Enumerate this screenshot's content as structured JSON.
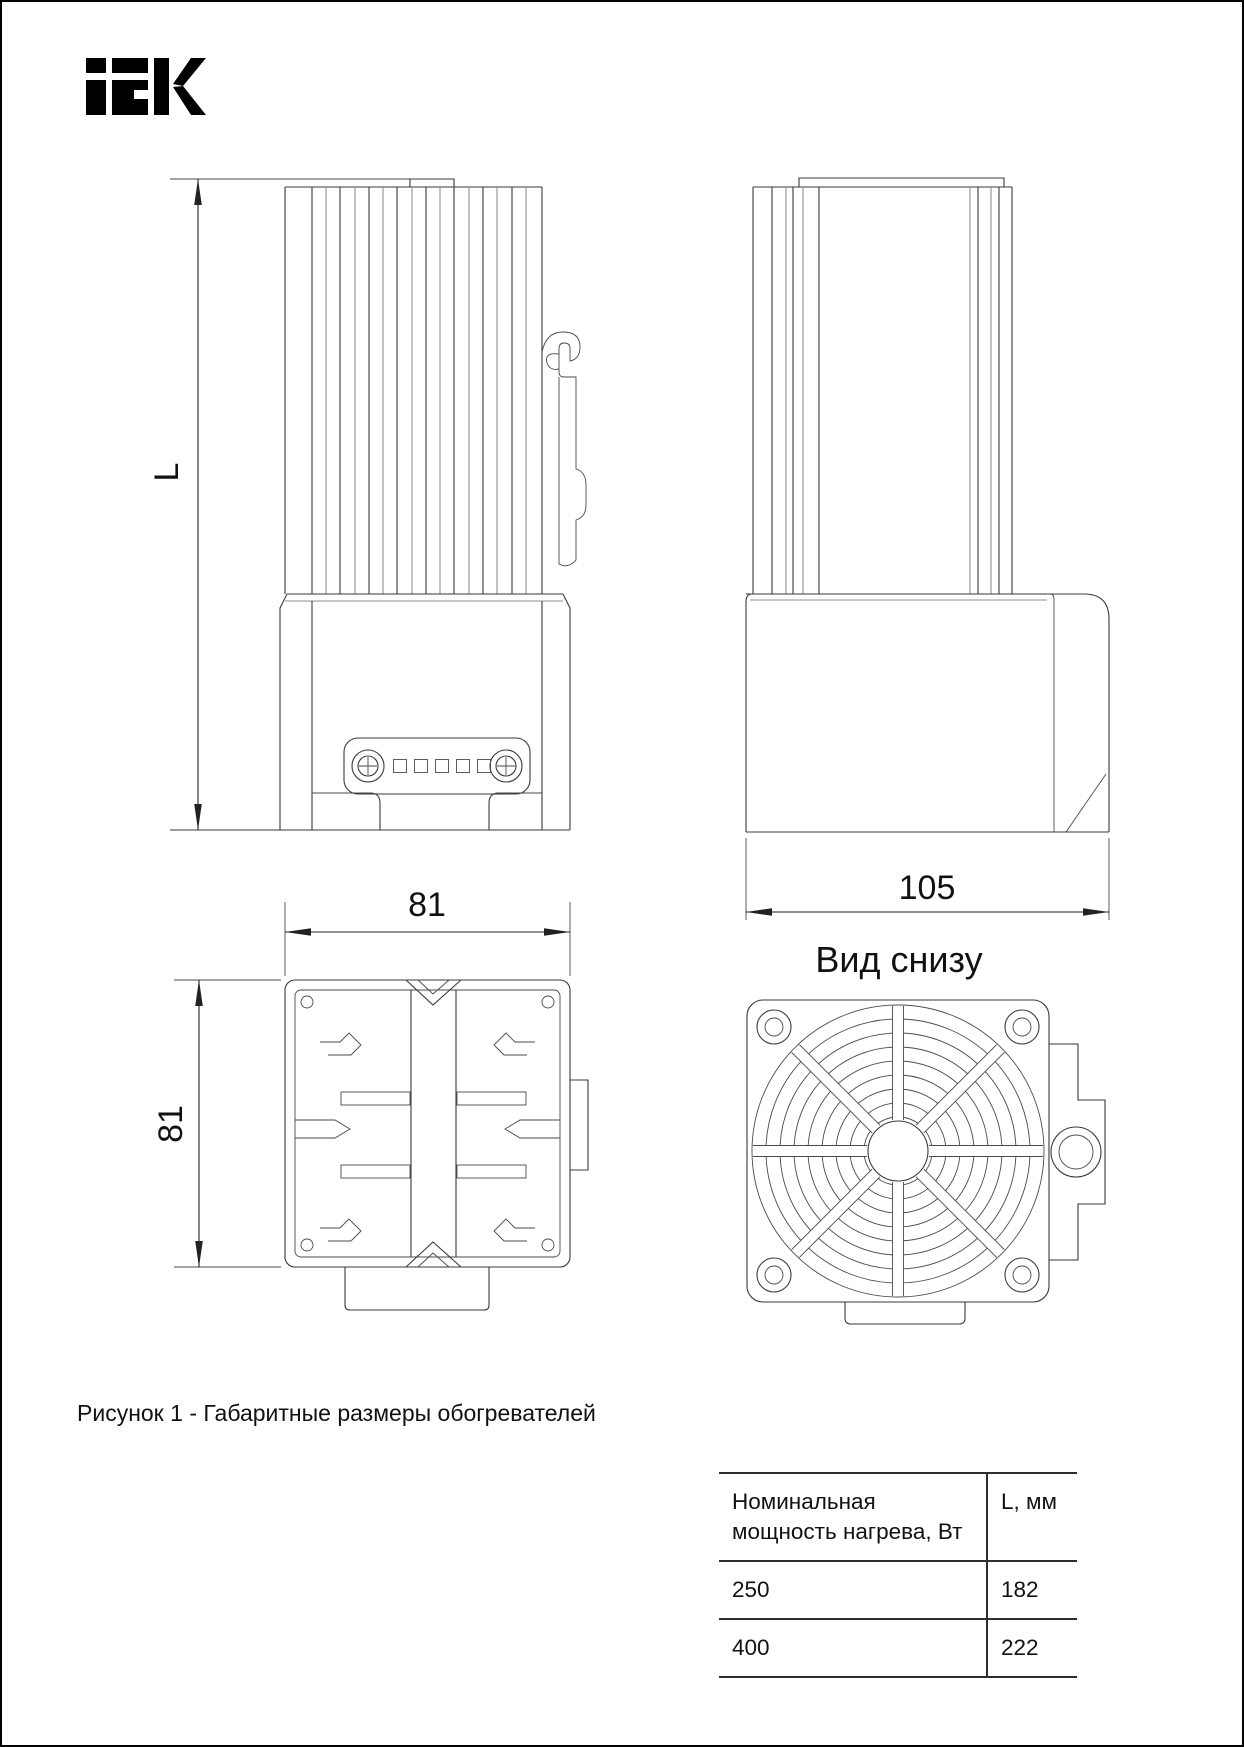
{
  "page": {
    "background": "#ffffff",
    "ink": "#111111",
    "line_color": "#3a3a3a"
  },
  "logo": {
    "name": "iek-logo",
    "text": "iEK",
    "color": "#000000"
  },
  "drawing": {
    "front_view": {
      "height_dim": "L"
    },
    "side_view": {
      "width_dim": "105"
    },
    "section_view": {
      "width_dim": "81",
      "height_dim": "81"
    },
    "bottom_view": {
      "title": "Вид снизу"
    }
  },
  "caption": {
    "text": "Рисунок 1 - Габаритные размеры обогревателей"
  },
  "table": {
    "header": {
      "power_line1": "Номинальная",
      "power_line2": "мощность нагрева, Вт",
      "length": "L, мм"
    },
    "rows": [
      {
        "power": "250",
        "length": "182"
      },
      {
        "power": "400",
        "length": "222"
      }
    ]
  }
}
